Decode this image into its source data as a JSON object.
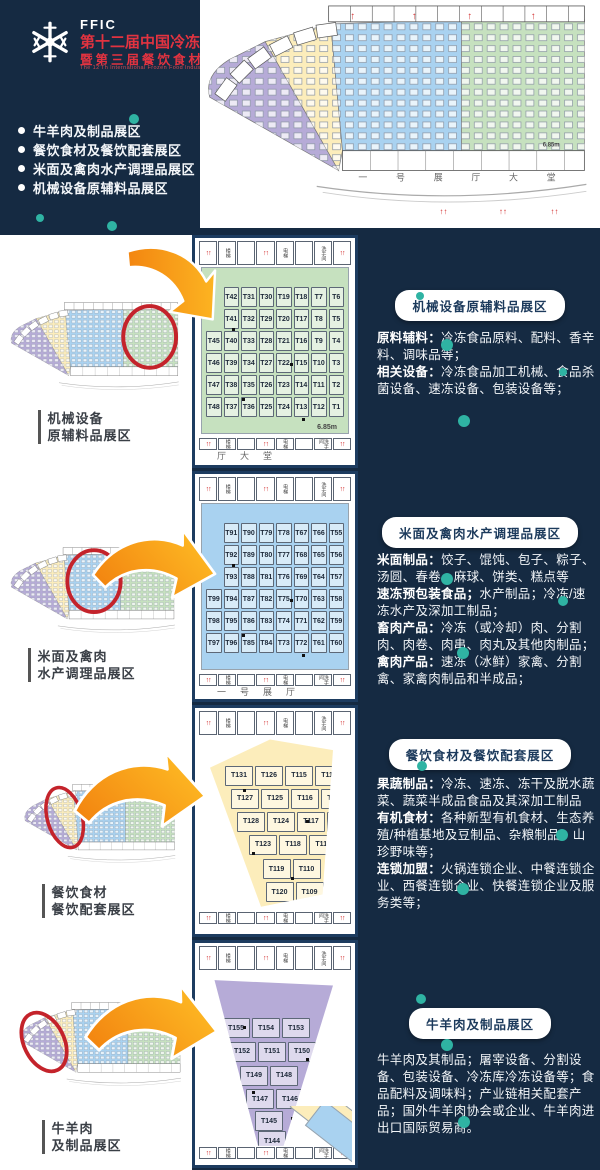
{
  "colors": {
    "background_navy": "#152a42",
    "panel_border_navy": "#1d3c60",
    "accent_red": "#e23340",
    "highlight_circle_red": "#c4232b",
    "teal_dot": "#2fb3a3",
    "arrow_orange_dark": "#f2820f",
    "arrow_orange_light": "#ffc026",
    "zone_purple": "#b6abd7",
    "zone_yellow": "#fcedbb",
    "zone_blue": "#a9d2f0",
    "zone_green": "#c6e1bf"
  },
  "header": {
    "logo": "FFIC",
    "title": "第十二届中国冷冻食品产业大会",
    "subtitle": "暨第三届餐饮食材博览会",
    "subtitle_en": "The 12'Th International Frozen Food Industry Conference",
    "bullets": [
      "牛羊肉及制品展区",
      "餐饮食材及餐饮配套展区",
      "米面及禽肉水产调理品展区",
      "机械设备原辅料品展区"
    ]
  },
  "map": {
    "corridor_text": "一号展厅大堂",
    "scale_label": "6.85m",
    "room_labels": [
      "楼梯",
      "电梯",
      "洗手间"
    ]
  },
  "sections": [
    {
      "zone": "green",
      "label_lines": [
        "机械设备",
        "原辅料品展区"
      ],
      "badge": "机械设备原辅料品展区",
      "paragraphs": [
        {
          "bold": "原料辅料：",
          "text": "冷冻食品原料、配料、香辛料、调味品等；"
        },
        {
          "bold": "相关设备：",
          "text": "冷冻食品加工机械、食品杀菌设备、速冻设备、包装设备等；"
        }
      ],
      "corridor_chars": "厅大堂",
      "scale_label": "6.85m",
      "booth_rows": [
        [
          "T42",
          "T31",
          "T30",
          "T19",
          "T18",
          "T7",
          "T6"
        ],
        [
          "T41",
          "T32",
          "T29",
          "T20",
          "T17",
          "T8",
          "T5"
        ],
        [
          "T45",
          "T40",
          "T33",
          "T28",
          "T21",
          "T16",
          "T9",
          "T4"
        ],
        [
          "T46",
          "T39",
          "T34",
          "T27",
          "T22",
          "T15",
          "T10",
          "T3"
        ],
        [
          "T47",
          "T38",
          "T35",
          "T26",
          "T23",
          "T14",
          "T11",
          "T2"
        ],
        [
          "T48",
          "T37",
          "T36",
          "T25",
          "T24",
          "T13",
          "T12",
          "T1"
        ]
      ]
    },
    {
      "zone": "blue",
      "label_lines": [
        "米面及禽肉",
        "水产调理品展区"
      ],
      "badge": "米面及禽肉水产调理品展区",
      "paragraphs": [
        {
          "bold": "米面制品：",
          "text": "饺子、馄饨、包子、粽子、汤圆、春卷、麻球、饼类、糕点等"
        },
        {
          "bold": "速冻预包装食品；",
          "text": "水产制品；冷冻/速冻水产及深加工制品；"
        },
        {
          "bold": "畜肉产品：",
          "text": "冷冻（或冷却）肉、分割肉、肉卷、肉串、肉丸及其他肉制品；"
        },
        {
          "bold": "禽肉产品：",
          "text": "速冻（冰鲜）家禽、分割禽、家禽肉制品和半成品；"
        }
      ],
      "corridor_chars": "一号展厅",
      "booth_rows": [
        [
          "T91",
          "T90",
          "T79",
          "T78",
          "T67",
          "T66",
          "T55"
        ],
        [
          "T92",
          "T89",
          "T80",
          "T77",
          "T68",
          "T65",
          "T56"
        ],
        [
          "T93",
          "T88",
          "T81",
          "T76",
          "T69",
          "T64",
          "T57"
        ],
        [
          "T99",
          "T94",
          "T87",
          "T82",
          "T75",
          "T70",
          "T63",
          "T58"
        ],
        [
          "T98",
          "T95",
          "T86",
          "T83",
          "T74",
          "T71",
          "T62",
          "T59"
        ],
        [
          "T97",
          "T96",
          "T85",
          "T84",
          "T73",
          "T72",
          "T61",
          "T60"
        ]
      ]
    },
    {
      "zone": "yellow",
      "label_lines": [
        "餐饮食材",
        "餐饮配套展区"
      ],
      "badge": "餐饮食材及餐饮配套展区",
      "paragraphs": [
        {
          "bold": "果蔬制品：",
          "text": "冷冻、速冻、冻干及脱水蔬菜、蔬菜半成品食品及其深加工制品"
        },
        {
          "bold": "有机食材：",
          "text": "各种新型有机食材、生态养殖/种植基地及豆制品、杂粮制品、山珍野味等；"
        },
        {
          "bold": "连锁加盟：",
          "text": "火锅连锁企业、中餐连锁企业、西餐连锁企业、快餐连锁企业及服务类等；"
        }
      ],
      "corridor_chars": "",
      "booth_rows": [
        [
          "T131",
          "T126",
          "T115",
          "T114"
        ],
        [
          "T127",
          "T125",
          "T116",
          "T113"
        ],
        [
          "T128",
          "T124",
          "T117",
          "T112"
        ],
        [
          "T123",
          "T118",
          "T111"
        ],
        [
          "T119",
          "T110"
        ],
        [
          "T120",
          "T109"
        ]
      ]
    },
    {
      "zone": "purple",
      "label_lines": [
        "牛羊肉",
        "及制品展区"
      ],
      "badge": "牛羊肉及制品展区",
      "paragraphs": [
        {
          "bold": "",
          "text": "牛羊肉及其制品；屠宰设备、分割设备、包装设备、冷冻库冷冻设备等；食品配料及调味料；产业链相关配套产品；国外牛羊肉协会或企业、牛羊肉进出口国际贸易商。"
        }
      ],
      "corridor_chars": "",
      "booth_rows": [
        [
          "T155",
          "T154",
          "T153"
        ],
        [
          "T152",
          "T151",
          "T150"
        ],
        [
          "T149",
          "T148"
        ],
        [
          "T147",
          "T146"
        ],
        [
          "T145"
        ],
        [
          "T144"
        ]
      ]
    }
  ]
}
